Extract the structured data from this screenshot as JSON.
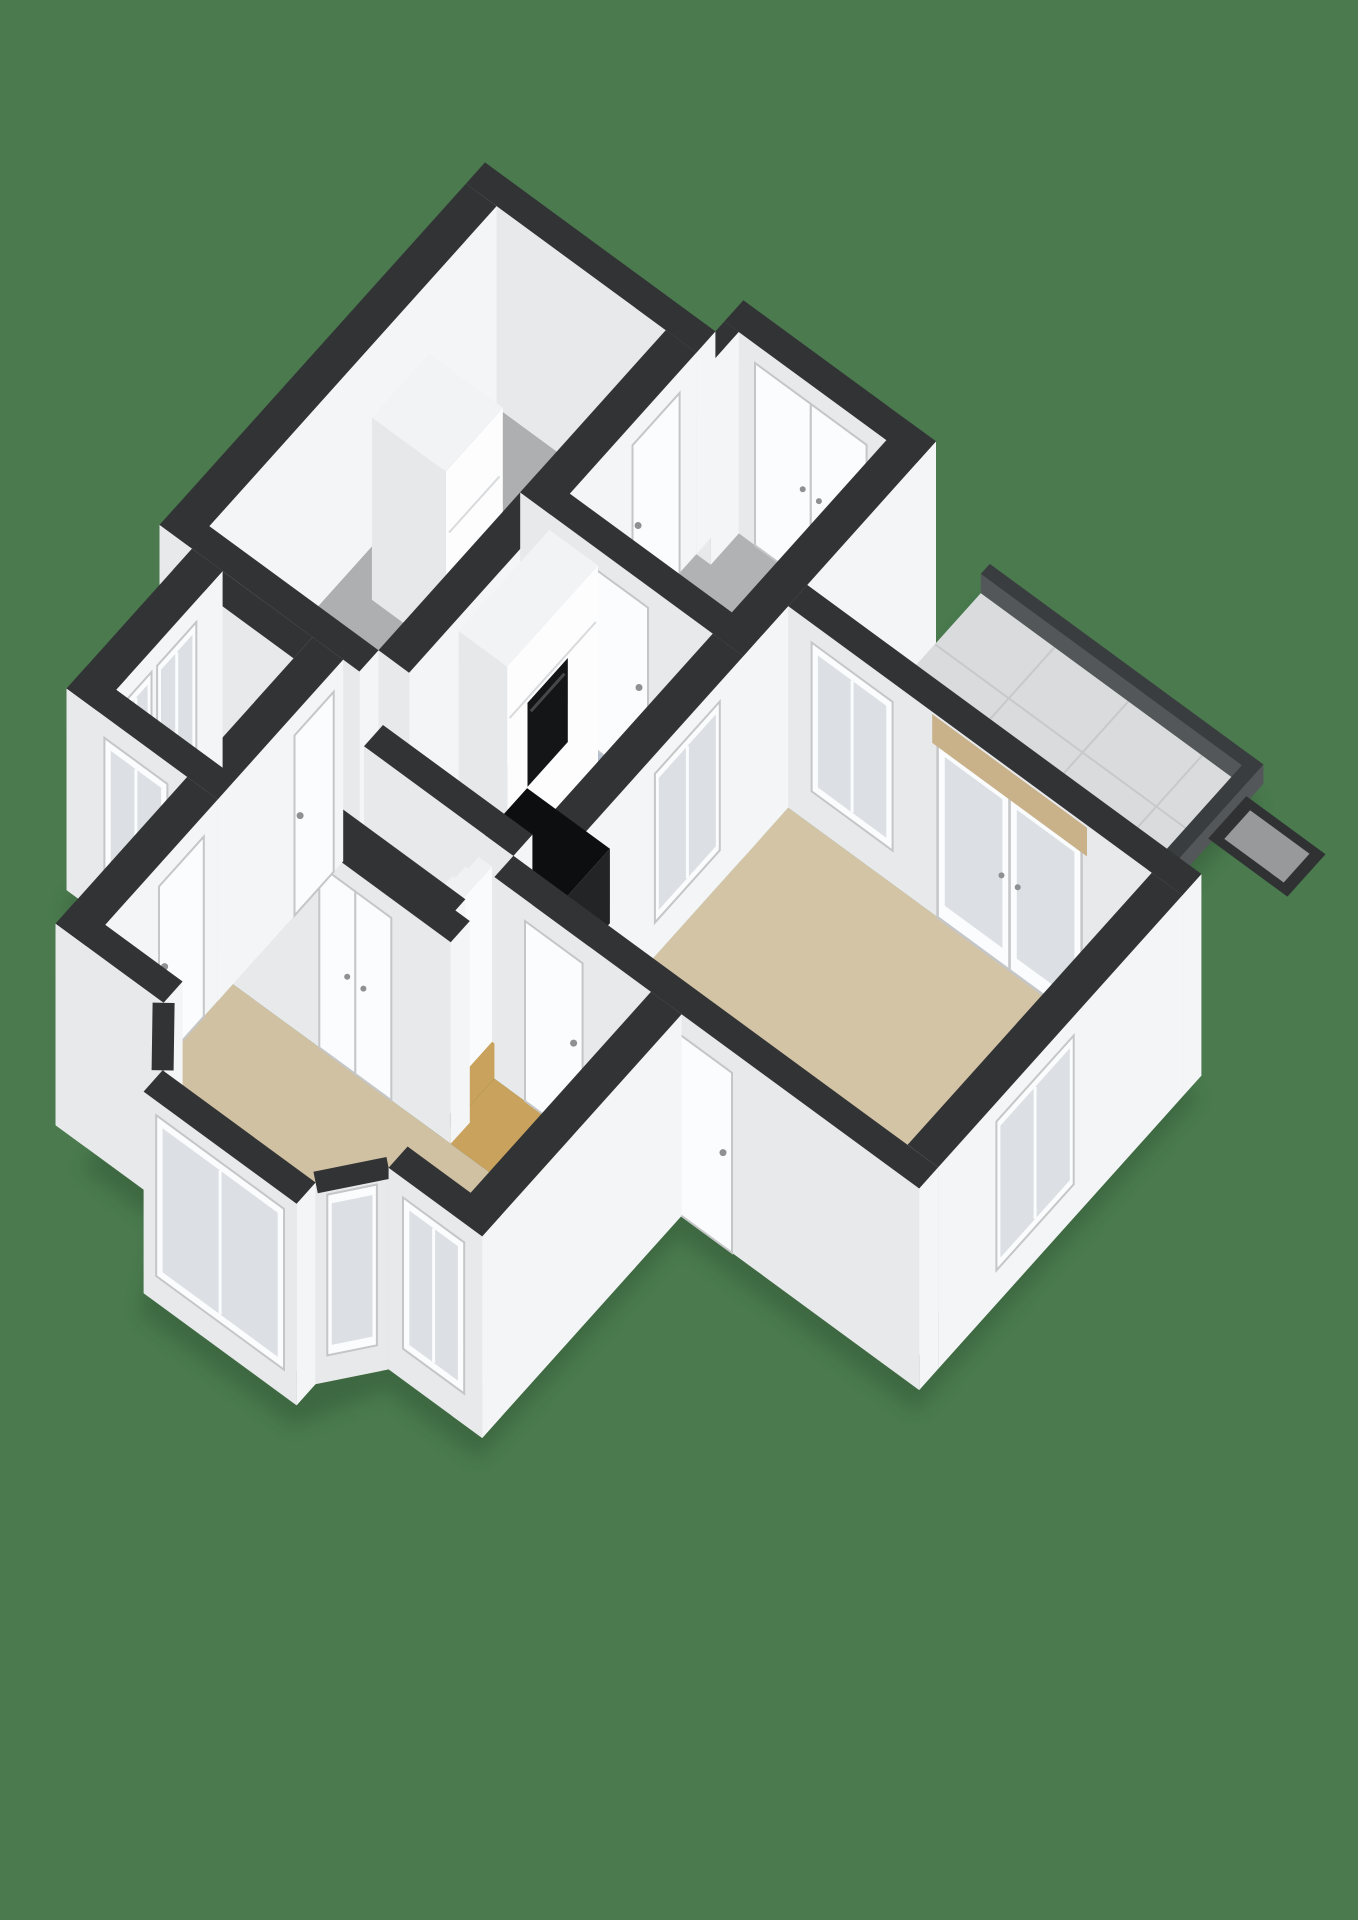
{
  "scene": {
    "description": "3D axonometric floor plan render on green background, no text labels",
    "projection": {
      "origin": [
        485,
        330
      ],
      "eu": [
        0.9,
        0.55
      ],
      "ev": [
        -0.56,
        0.52
      ],
      "wallHeight": 168,
      "yStretch": 1.2,
      "yAnchor": 160
    },
    "colors": {
      "background": "#4a7a4e",
      "shadow": "#2e5233",
      "wallTop": "#313335",
      "faceS": "#e7e9eb",
      "faceE": "#f4f5f7",
      "rimTop": "#3a3d3f",
      "rimFace": "#54575a",
      "floorGarage": "#adafb1",
      "floorEntry": "#b0b2b4",
      "floorKitchen": "#b4bfcf",
      "floorRight": "#d4c4a6",
      "floorHall": "#c9a25d",
      "floorBed": "#b1955d",
      "floorLiving": "#d1c1a3",
      "terrace": "#d9dbdd",
      "tileLine": "#c7c9cb",
      "white": "#fbfcfd",
      "frame": "#c4c6c8",
      "glass": "#dce0e4",
      "handle": "#8e9092",
      "blind": "#c9b28a",
      "oven": "#141517",
      "ovenHandle": "#45474a",
      "islandTop": "#0d0e10",
      "islandS": "#191b1d",
      "islandE": "#222426",
      "stepTop": "#f0f1f3",
      "stepS": "#dfe1e3",
      "stepE": "#fafbfc",
      "cabinetTop": "#f2f3f5",
      "cabS": "#e6e8ea",
      "cabE": "#fdfdfe",
      "matBorder": "#2f3133",
      "matFill": "#97999b",
      "seam": "#d8dadc"
    },
    "shadowHull": [
      [
        0,
        0
      ],
      [
        256,
        0
      ],
      [
        256,
        -50
      ],
      [
        470,
        -50
      ],
      [
        470,
        -146
      ],
      [
        774,
        -146
      ],
      [
        774,
        180
      ],
      [
        908,
        180
      ],
      [
        908,
        684
      ],
      [
        644,
        684
      ],
      [
        644,
        1040
      ],
      [
        540,
        1040
      ],
      [
        500,
        1140
      ],
      [
        330,
        1140
      ],
      [
        290,
        1040
      ],
      [
        204,
        1040
      ],
      [
        204,
        805
      ],
      [
        36,
        805
      ],
      [
        36,
        581
      ],
      [
        0,
        581
      ]
    ],
    "floors": [
      {
        "name": "floor-terrace",
        "colorKey": "terrace",
        "rect": [
          470,
          -130,
          760,
          180
        ]
      },
      {
        "name": "floor-entry",
        "colorKey": "floorEntry",
        "rect": [
          256,
          -16,
          436,
          260
        ]
      },
      {
        "name": "floor-garage",
        "colorKey": "floorGarage",
        "rect": [
          34,
          34,
          222,
          547
        ]
      },
      {
        "name": "floor-kitchen",
        "colorKey": "floorKitchen",
        "rect": [
          256,
          294,
          436,
          616
        ]
      },
      {
        "name": "floor-right-room",
        "colorKey": "floorRight",
        "rect": [
          470,
          214,
          874,
          650
        ]
      },
      {
        "name": "floor-hall",
        "colorKey": "floorHall",
        "rect": [
          204,
          581,
          436,
          744
        ]
      },
      {
        "name": "floor-hall-sliver",
        "colorKey": "floorHall",
        "rect": [
          256,
          616,
          300,
          650
        ]
      },
      {
        "name": "floor-hall-corridor",
        "colorKey": "floorHall",
        "rect": [
          222,
          547,
          256,
          581
        ]
      },
      {
        "name": "floor-hall-passage",
        "colorKey": "floorHall",
        "rect": [
          436,
          684,
          610,
          778
        ]
      },
      {
        "name": "floor-bedroom",
        "colorKey": "floorBed",
        "rect": [
          70,
          615,
          170,
          771
        ]
      },
      {
        "name": "floor-living",
        "colorKey": "floorLiving",
        "poly": [
          [
            204,
            778
          ],
          [
            610,
            778
          ],
          [
            610,
            1006
          ],
          [
            540,
            1006
          ],
          [
            540,
            1040
          ],
          [
            500,
            1106
          ],
          [
            330,
            1106
          ],
          [
            290,
            1040
          ],
          [
            290,
            1006
          ],
          [
            204,
            1006
          ]
        ]
      }
    ],
    "tileGrid": {
      "rect": [
        470,
        -130,
        760,
        180
      ],
      "pitch": 82
    },
    "rims": [
      {
        "name": "terrace-rim-north",
        "rect": [
          470,
          -146,
          774,
          -130
        ],
        "h": 16
      },
      {
        "name": "terrace-rim-east",
        "rect": [
          760,
          -146,
          774,
          180
        ],
        "h": 16
      }
    ],
    "doormat": {
      "name": "doormat",
      "rect": [
        770,
        -122,
        858,
        -54
      ],
      "inset": 11
    },
    "prisms": [
      {
        "name": "wall-north-entry",
        "type": "wall",
        "rect": [
          256,
          -50,
          470,
          -16
        ],
        "h": 168,
        "openings": [
          {
            "kind": "double-door",
            "face": "S",
            "a": 290,
            "b": 414,
            "h0": 0,
            "h1": 152,
            "name": "front-doors"
          }
        ]
      },
      {
        "name": "wall-north-jog",
        "type": "wall",
        "rect": [
          256,
          -16,
          272,
          34
        ],
        "h": 168
      },
      {
        "name": "wall-north-garage",
        "type": "wall",
        "rect": [
          0,
          0,
          256,
          34
        ],
        "h": 168
      },
      {
        "name": "wall-east-entry",
        "type": "wall",
        "rect": [
          436,
          -50,
          470,
          294
        ],
        "h": 168
      },
      {
        "name": "wall-west-garage",
        "type": "wall",
        "rect": [
          0,
          34,
          34,
          581
        ],
        "h": 168
      },
      {
        "name": "garage-cabinet",
        "type": "cabinet",
        "rect": [
          66,
          206,
          148,
          308
        ],
        "h": 152,
        "openings": [
          {
            "kind": "seam",
            "face": "E",
            "a": 212,
            "b": 302,
            "hs": 58,
            "name": "cabinet-seam-1"
          },
          {
            "kind": "seam",
            "face": "E",
            "a": 212,
            "b": 302,
            "hs": 98,
            "name": "cabinet-seam-2"
          }
        ]
      },
      {
        "name": "wall-east-garage",
        "type": "wall",
        "rect": [
          222,
          34,
          256,
          547
        ],
        "h": 168,
        "openings": [
          {
            "kind": "door",
            "face": "E",
            "a": 64,
            "b": 148,
            "h0": 0,
            "h1": 150,
            "name": "garage-entry-door"
          }
        ]
      },
      {
        "name": "wall-south-entry",
        "type": "wall",
        "rect": [
          222,
          260,
          470,
          294
        ],
        "h": 168,
        "openings": [
          {
            "kind": "door",
            "face": "S",
            "a": 300,
            "b": 364,
            "h0": 0,
            "h1": 150,
            "name": "entry-kitchen-door"
          }
        ]
      },
      {
        "name": "kitchen-cabinets",
        "type": "cabinet",
        "rect": [
          262,
          306,
          316,
          468
        ],
        "h": 165,
        "openings": [
          {
            "kind": "oven",
            "face": "E",
            "a": 360,
            "b": 432,
            "h0": 46,
            "h1": 116,
            "name": "built-in-oven"
          },
          {
            "kind": "seam",
            "face": "E",
            "a": 310,
            "b": 464,
            "hs": 120,
            "name": "kitchen-cabinet-seam"
          }
        ]
      },
      {
        "name": "wall-kitchen-right",
        "type": "wall",
        "rect": [
          436,
          294,
          470,
          650
        ],
        "h": 168,
        "openings": [
          {
            "kind": "window",
            "face": "E",
            "a": 336,
            "b": 452,
            "h0": 28,
            "h1": 152,
            "name": "kitchen-interior-window"
          }
        ]
      },
      {
        "name": "wall-north-right-room",
        "type": "wall",
        "rect": [
          470,
          180,
          908,
          214
        ],
        "h": 168,
        "openings": [
          {
            "kind": "window",
            "face": "S",
            "a": 496,
            "b": 586,
            "h0": 28,
            "h1": 152,
            "name": "right-room-interior-window"
          },
          {
            "kind": "french-door",
            "face": "S",
            "a": 636,
            "b": 796,
            "h0": 0,
            "h1": 150,
            "name": "terrace-french-doors"
          },
          {
            "kind": "blind",
            "face": "S",
            "a": 630,
            "b": 802,
            "h0": 142,
            "h1": 166,
            "name": "blind-box"
          }
        ]
      },
      {
        "name": "wall-east-right-room",
        "type": "wall",
        "rect": [
          874,
          214,
          908,
          650
        ],
        "h": 168,
        "openings": [
          {
            "kind": "window",
            "face": "E",
            "a": 408,
            "b": 546,
            "h0": 28,
            "h1": 152,
            "name": "right-room-window"
          }
        ]
      },
      {
        "name": "kitchen-island",
        "type": "island",
        "rect": [
          328,
          452,
          420,
          538
        ],
        "h": 62
      },
      {
        "name": "wall-south-garage",
        "type": "wall",
        "rect": [
          0,
          547,
          222,
          581
        ],
        "h": 168
      },
      {
        "name": "wall-south-kitchen",
        "type": "wall",
        "rect": [
          270,
          616,
          436,
          650
        ],
        "h": 168
      },
      {
        "name": "stairs",
        "type": "stairs",
        "x0": 280,
        "z0": 650,
        "z1": 726,
        "count": 9,
        "stepW": 14.7,
        "h0": 18,
        "dh": 16
      },
      {
        "name": "stairs-stringer-south",
        "type": "wall",
        "rect": [
          260,
          726,
          430,
          748
        ],
        "h": 168
      },
      {
        "name": "wall-south-right-room",
        "type": "wall",
        "rect": [
          436,
          650,
          908,
          684
        ],
        "h": 168,
        "openings": [
          {
            "kind": "door",
            "face": "S",
            "a": 470,
            "b": 534,
            "h0": 0,
            "h1": 150,
            "name": "hall-right-room-door"
          },
          {
            "kind": "door",
            "face": "S",
            "a": 636,
            "b": 700,
            "h0": 0,
            "h1": 150,
            "name": "living-right-room-door"
          }
        ]
      },
      {
        "name": "wall-north-living",
        "type": "wall",
        "rect": [
          204,
          744,
          446,
          778
        ],
        "h": 168,
        "openings": [
          {
            "kind": "double-door",
            "face": "S",
            "a": 300,
            "b": 380,
            "h0": 0,
            "h1": 152,
            "name": "hall-living-doors"
          }
        ]
      },
      {
        "name": "wall-north-bedroom",
        "type": "wall",
        "rect": [
          36,
          581,
          170,
          615
        ],
        "h": 168
      },
      {
        "name": "wall-east-bedroom",
        "type": "wall",
        "rect": [
          170,
          581,
          204,
          805
        ],
        "h": 168,
        "openings": [
          {
            "kind": "door",
            "face": "E",
            "a": 598,
            "b": 668,
            "h0": 0,
            "h1": 150,
            "name": "bedroom-door"
          }
        ]
      },
      {
        "name": "wall-west-bedroom",
        "type": "wall",
        "rect": [
          36,
          581,
          70,
          805
        ],
        "h": 168,
        "openings": [
          {
            "kind": "window",
            "face": "E",
            "a": 628,
            "b": 698,
            "h0": 26,
            "h1": 150,
            "name": "bedroom-window-1"
          },
          {
            "kind": "window",
            "face": "E",
            "a": 708,
            "b": 764,
            "h0": 26,
            "h1": 150,
            "name": "bedroom-window-2"
          }
        ]
      },
      {
        "name": "wall-south-bedroom",
        "type": "wall",
        "rect": [
          36,
          771,
          204,
          805
        ],
        "h": 168,
        "openings": [
          {
            "kind": "window",
            "face": "S",
            "a": 78,
            "b": 148,
            "h0": 26,
            "h1": 150,
            "name": "bedroom-window-3"
          }
        ]
      },
      {
        "name": "wall-west-living",
        "type": "wall",
        "rect": [
          170,
          805,
          204,
          1040
        ],
        "h": 168,
        "openings": [
          {
            "kind": "door",
            "face": "E",
            "a": 830,
            "b": 910,
            "h0": 0,
            "h1": 150,
            "name": "front-hall-door"
          }
        ]
      },
      {
        "name": "wall-south-living-west",
        "type": "wall",
        "rect": [
          170,
          1006,
          290,
          1040
        ],
        "h": 168
      },
      {
        "name": "bay-wall-southwest",
        "type": "polywall",
        "p1": [
          290,
          1040
        ],
        "p2": [
          330,
          1106
        ],
        "h": 168,
        "window": {
          "t0": 0.16,
          "t1": 0.84,
          "h0": 22,
          "h1": 156,
          "name": "bay-window-west"
        }
      },
      {
        "name": "bay-wall-front",
        "type": "wall",
        "rect": [
          330,
          1106,
          500,
          1140
        ],
        "h": 168,
        "openings": [
          {
            "kind": "window",
            "face": "S",
            "a": 344,
            "b": 486,
            "h0": 22,
            "h1": 156,
            "name": "bay-window-center"
          }
        ]
      },
      {
        "name": "bay-wall-southeast",
        "type": "polywall",
        "p1": [
          500,
          1106
        ],
        "p2": [
          540,
          1040
        ],
        "h": 168,
        "window": {
          "t0": 0.16,
          "t1": 0.84,
          "h0": 22,
          "h1": 156,
          "name": "bay-window-east"
        }
      },
      {
        "name": "wall-east-living",
        "type": "wall",
        "rect": [
          610,
          684,
          644,
          1040
        ],
        "h": 168
      },
      {
        "name": "wall-south-living-east",
        "type": "wall",
        "rect": [
          540,
          1006,
          644,
          1040
        ],
        "h": 168,
        "openings": [
          {
            "kind": "window",
            "face": "S",
            "a": 556,
            "b": 624,
            "h0": 26,
            "h1": 152,
            "name": "living-window-east"
          }
        ]
      }
    ]
  }
}
